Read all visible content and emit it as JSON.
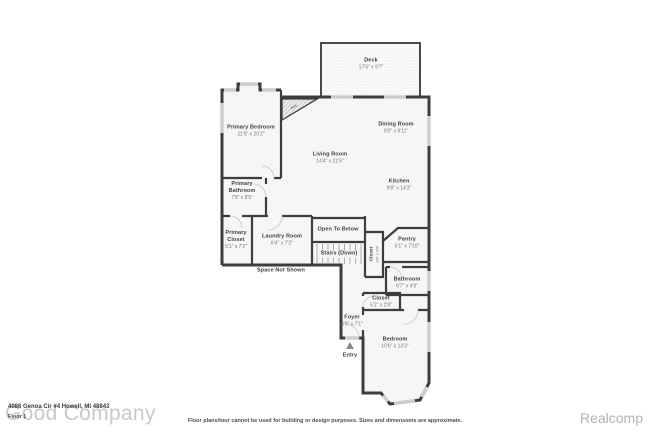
{
  "colors": {
    "wall": "#3d3d3d",
    "window": "#cdcdcd",
    "room_fill": "#f6f6f6",
    "deck_fill": "#fafafa",
    "room_name_text": "#3f3f3f",
    "dimension_text": "#787878",
    "watermark_gray": "#c9c9c9",
    "brand_gray": "#b3b3b3"
  },
  "rooms": [
    {
      "name": "Deck",
      "dims": "17'6\" x 9'7\""
    },
    {
      "name": "Primary Bedroom",
      "dims": "11'9\" x 20'2\""
    },
    {
      "name": "Living Room",
      "dims": "14'4\" x 21'6\""
    },
    {
      "name": "Dining Room",
      "dims": "9'0\" x 9'11\""
    },
    {
      "name": "Kitchen",
      "dims": "9'8\" x 14'3\""
    },
    {
      "name": "Primary Bathroom",
      "dims": "7'9\" x 8'5\""
    },
    {
      "name": "Primary Closet",
      "dims": "5'1\" x 7'2\""
    },
    {
      "name": "Laundry Room",
      "dims": "6'4\" x 7'2\""
    },
    {
      "name": "Open To Below"
    },
    {
      "name": "Stairs (Down)"
    },
    {
      "name": "Space Not Shown"
    },
    {
      "name": "Pantry",
      "dims": "6'1\" x 7'10\""
    },
    {
      "name": "Closet",
      "dims": "2'8\" x 6'8\""
    },
    {
      "name": "Bathroom",
      "dims": "6'7\" x 4'9\""
    },
    {
      "name": "Closet",
      "dims": "5'2\" x 2'8\""
    },
    {
      "name": "Foyer",
      "dims": "4'9\" x 7'1\""
    },
    {
      "name": "Entry"
    },
    {
      "name": "Bedroom",
      "dims": "10'6\" x 13'3\""
    },
    {
      "name": "Fire"
    }
  ],
  "footer": {
    "address": "4086 Genoa Cir #4 Howell, MI 48843",
    "floor_label": "Floor 1",
    "watermark": "Good Company",
    "disclaimer": "Floor plans/tour cannot be used for building or design purposes. Sizes and dimensions are approximate.",
    "brand": "Realcomp"
  }
}
